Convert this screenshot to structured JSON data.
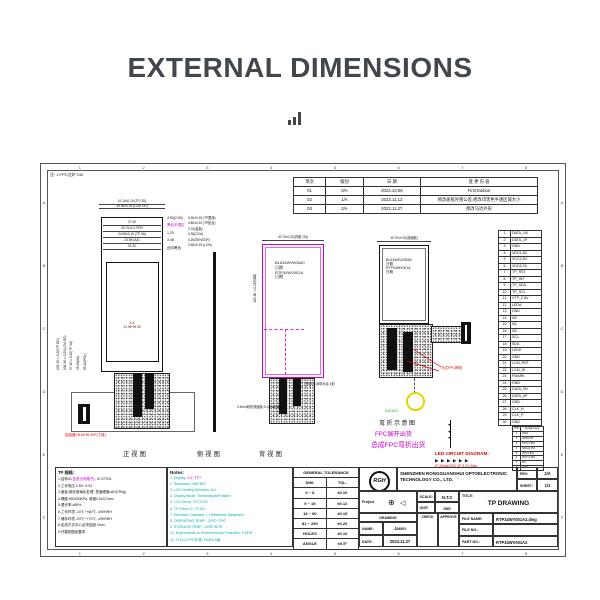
{
  "icons": {
    "led_diode": "▶",
    "diode_down": "▼",
    "proj_circle": "⊕",
    "proj_cone": "◁",
    "dot": "●"
  },
  "header": {
    "title": "EXTERNAL DIMENSIONS"
  },
  "drawing": {
    "frame": {
      "top_note": "注: 1.FPC过炉 240",
      "col_numbers": [
        "1",
        "2",
        "3",
        "4",
        "5",
        "6",
        "7",
        "8"
      ],
      "row_letters": [
        "A",
        "B",
        "C",
        "D",
        "E",
        "F"
      ]
    },
    "revision_table": {
      "headers": [
        "项次",
        "版别",
        "日  期",
        "变  更  内  容"
      ],
      "rows": [
        [
          "01",
          "0/A",
          "2023.10.09",
          "First Edition"
        ],
        [
          "02",
          "1/A",
          "2023.11.13",
          "修改盖板外围公差,修改印黑色半透区域大小"
        ],
        [
          "03",
          "2/A",
          "2023.11.27",
          "修改马达外形"
        ]
      ]
    },
    "pin_table": {
      "rows": [
        [
          "1",
          "DATA_1N"
        ],
        [
          "2",
          "DATA_1P"
        ],
        [
          "3",
          "GND"
        ],
        [
          "4",
          "VDD1.8V"
        ],
        [
          "5",
          "VCC2.8V"
        ],
        [
          "6",
          "VDD3.3V"
        ],
        [
          "7",
          "TP_RST"
        ],
        [
          "8",
          "TP_INT"
        ],
        [
          "9",
          "TP_SDA"
        ],
        [
          "10",
          "TP_SCL"
        ],
        [
          "11",
          "VTP_2.8V"
        ],
        [
          "12",
          "LEDA"
        ],
        [
          "13",
          "GND"
        ],
        [
          "14",
          "NC"
        ],
        [
          "15",
          "NC"
        ],
        [
          "16",
          "NC"
        ],
        [
          "17",
          "SCL"
        ],
        [
          "18",
          "SDA"
        ],
        [
          "19",
          "LEDK"
        ],
        [
          "20",
          "GND"
        ],
        [
          "21",
          "LCM_RST"
        ],
        [
          "22",
          "LCM_ID"
        ],
        [
          "23",
          "FMARK"
        ],
        [
          "24",
          "GND"
        ],
        [
          "25",
          "DATA_0N"
        ],
        [
          "26",
          "DATA_0P"
        ],
        [
          "27",
          "GND"
        ],
        [
          "28",
          "CLK_N"
        ],
        [
          "29",
          "CLK_P"
        ],
        [
          "30",
          "GND"
        ]
      ]
    },
    "front_view": {
      "caption": "正视图",
      "above_dims": [
        "41.10±0.10 (TP OD)",
        "39.96±0.25 (LCM OD)"
      ],
      "inner_dims": [
        "27.30",
        "26.70±0.2  PER",
        "24.59±0.15 (TP VA)",
        "23.98 (AA)",
        "31.30"
      ],
      "right_labels": [
        {
          "text": "4.90(2.80)",
          "color": "#111"
        },
        {
          "text": "黑色半透区",
          "color": "#cf00cf"
        },
        {
          "text": "1.20",
          "color": "#111"
        },
        {
          "text": "3.46",
          "color": "#111"
        },
        {
          "text": "丝印黑色",
          "color": "#111"
        }
      ],
      "left_dims": [
        "109.13±0.20(TP OD)",
        "106.96±0.25(LCM OD)",
        "97.10±0.15(TP VA)",
        "95.98(AA)",
        "85.10(POL)"
      ],
      "aa_lines": [
        "A.A",
        "23.98*95.98"
      ],
      "connector_note": "连接器:0510HS-30P(下接)"
    },
    "side_view": {
      "caption": "侧视图",
      "stack_dims": [
        "5.30±0.15 (TP整体)",
        "4.80±0.10 (TP贴合)",
        "0.70(盖板)",
        "0.35(OCA)",
        "0.20(SENSOR)",
        "2.65±0.15 (LCM)"
      ]
    },
    "back_view": {
      "caption": "背视图",
      "top_dim": "40.70±0.20(背胶 OD)",
      "inner_lines": [
        "BL634WV005A0",
        "日期",
        "RTP34WV001A",
        "日期"
      ],
      "left_dim": "105.80±0.25(背胶)",
      "tesa_note": "TESA 0.05防水区 4处",
      "adhesive_note": "0.3mm耐折双面胶-0.1(3M双面胶)"
    },
    "bend_view": {
      "top_dim": "40.70±0.20(双面胶)",
      "inner_lines": [
        "BL634WV005A0",
        "日期",
        "RTP34WV001A",
        "日期"
      ],
      "red_label": "马达FPC焊线",
      "green_dim": "6.10±0.5",
      "caption": "弯折示意图",
      "magenta_note1": "FPC展开出货",
      "magenta_note2": "总成FPC弯折出货"
    },
    "led_circuit": {
      "title": "LED CIRCUIT DIAGRAM:",
      "note": "IF:20mA/LED  VF:3.2V Max",
      "diodes": [
        "▶",
        "▶",
        "▶",
        "▶",
        "▶",
        "▶"
      ],
      "pin_table": {
        "headers": [
          "PIN",
          "Assignment"
        ],
        "rows": [
          [
            "1",
            "GND"
          ],
          [
            "2",
            "VDD2.8V"
          ],
          [
            "3",
            "SCL(1.8V)"
          ],
          [
            "4",
            "SDA(1.8V)"
          ],
          [
            "5",
            "INT(1.8V)"
          ],
          [
            "6",
            "RST(1.8V)"
          ],
          [
            "7",
            "NC"
          ],
          [
            "8",
            "GND"
          ]
        ]
      }
    },
    "tp_notes": {
      "title": "TP 规格:",
      "line1_prefix": "1.结构IC",
      "line1_highlight": "(信息见规格书)",
      "line1_suffix": ", IC:GT911",
      "lines": [
        "2.工作电压:2.8V~3.3V",
        "3.盖板:钢化玻璃化处理, 表面硬度≥6H(750g)",
        "4.硬度:650±50KPa, 厚度2.5±0.2mm",
        "5.透光率:≥85%",
        "6.工作环境:-10℃~+60℃, ≤90%RH",
        "7.储存环境:-20℃~+70℃, ≤90%RH",
        "8.走线方式中心必须加固 2mm",
        "9.开模按图纸要求"
      ]
    },
    "notes": {
      "title": "Notes:",
      "line1_prefix": "1. Display: ",
      "line1_highlight": "3.4',  TFT",
      "lines": [
        "2. Resolution: 480*800",
        "3. LCD Viewing Direction: ALL",
        "4. Display Mode: Transmissive/Positive",
        "5. LCD Driver: ST7701S",
        "6. TP Driver IC: GT911",
        "7. Electrical Character: ( ) Reference Datasheet",
        "8. OPERATING TEMP: -20℃~70℃",
        "9. STORAGE TEMP: -30℃~80℃",
        "10. Experiments on Environmental Protection: ROHS",
        "11. 0714-2 FPC补强 / RoHS A级"
      ]
    },
    "tolerance_table": {
      "title": "GENERAL TOLERANCE",
      "headers": [
        "DIM.",
        "TOL."
      ],
      "rows": [
        [
          "0  ~  8",
          "±0.10"
        ],
        [
          "9  ~  15",
          "±0.12"
        ],
        [
          "16  ~  80",
          "±0.15"
        ],
        [
          "81 ~ 250",
          "±0.20"
        ],
        [
          "HOLES",
          "±0.10"
        ],
        [
          "ANGLE",
          "±0.5°"
        ]
      ]
    },
    "title_block": {
      "logo": "RGH",
      "company": "SHENZHEN RONGGUANGHUI OPTOELECTRONIC TECHNOLOGY CO., LTD.",
      "rev_label": "REV:",
      "rev": "2/A",
      "sheet_label": "SHEET:",
      "sheet": "1/1",
      "project_label": "Project",
      "scale_label": "SCALE:",
      "scale": "N.T.S",
      "unit_label": "UNIT:",
      "unit": "mm",
      "title_label": "TITLE:",
      "title": "TP DRAWING",
      "drawing_label": "DRAWING",
      "name_label": "NAME:",
      "name": "Jason",
      "date_label": "DATE:",
      "date": "2023.11.27",
      "check_label": "CHECK",
      "approve_label": "APPROVE",
      "file_name_label": "FILE NAME:",
      "file_name": "RTP34WV001A2.dwg",
      "file_no_label": "FILE NO.:",
      "part_no_label": "PART NO.:",
      "part_no": "RTP34WV001A2"
    }
  }
}
